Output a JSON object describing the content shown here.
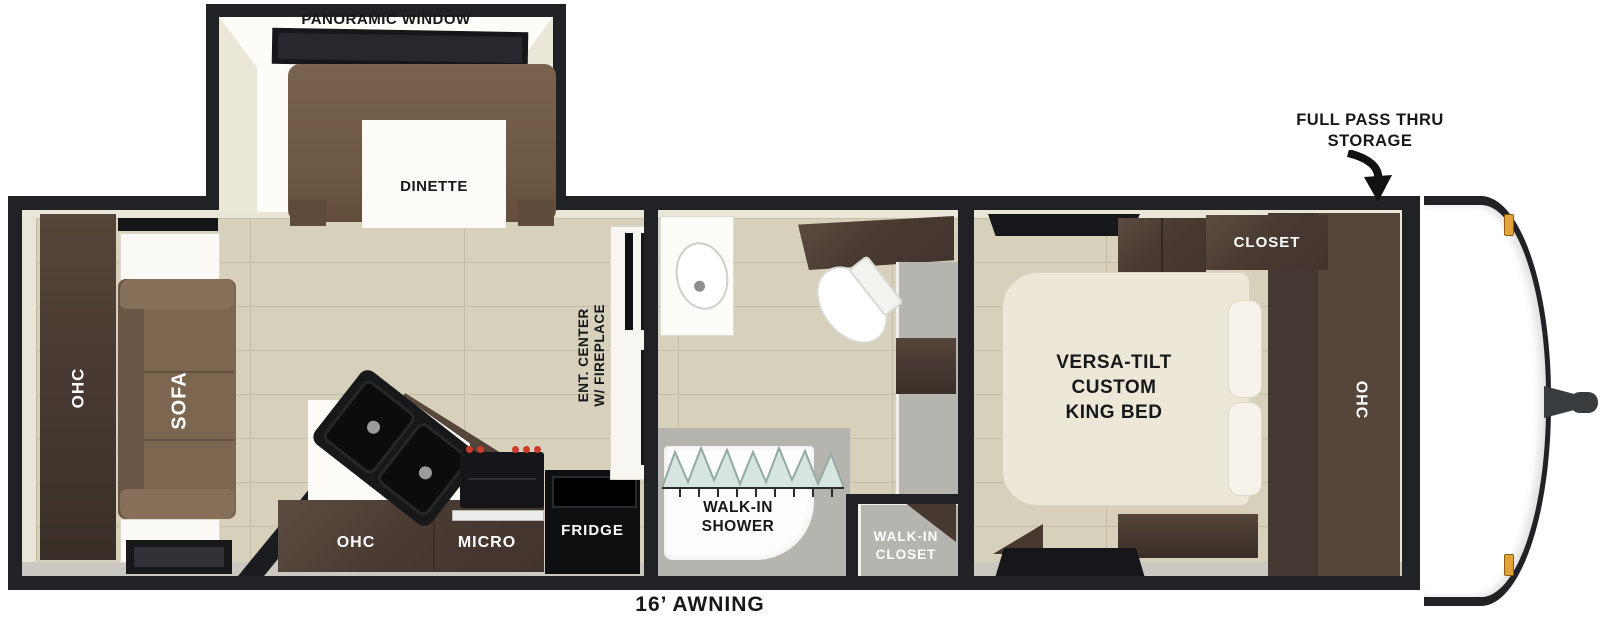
{
  "slideout": {
    "window_label": "PANORAMIC WINDOW",
    "dinette_label": "DINETTE"
  },
  "storage_callout": {
    "line1": "FULL PASS THRU",
    "line2": "STORAGE"
  },
  "bedroom": {
    "closet": "CLOSET",
    "ohc": "OHC",
    "bed_line1": "VERSA-TILT",
    "bed_line2": "CUSTOM",
    "bed_line3": "KING BED"
  },
  "bathroom": {
    "shower_line1": "WALK-IN",
    "shower_line2": "SHOWER",
    "closet_line1": "WALK-IN",
    "closet_line2": "CLOSET"
  },
  "living": {
    "sofa": "SOFA",
    "rear_ohc": "OHC",
    "ent_line1": "ENT. CENTER",
    "ent_line2": "W/ FIREPLACE"
  },
  "kitchen": {
    "ohc": "OHC",
    "micro": "MICRO",
    "fridge": "FRIDGE"
  },
  "awning": {
    "label": "16’ AWNING"
  },
  "colors": {
    "wall": "#212225",
    "floor_wood": "#d7d0bb",
    "dark_wood": "#4a3b32",
    "sofa_brown": "#7c664f",
    "bed_cream": "#ece7d7",
    "burner_red": "#d03a2a",
    "marker_amber": "#e2a23b",
    "shower_glass": "#d6e5df"
  }
}
